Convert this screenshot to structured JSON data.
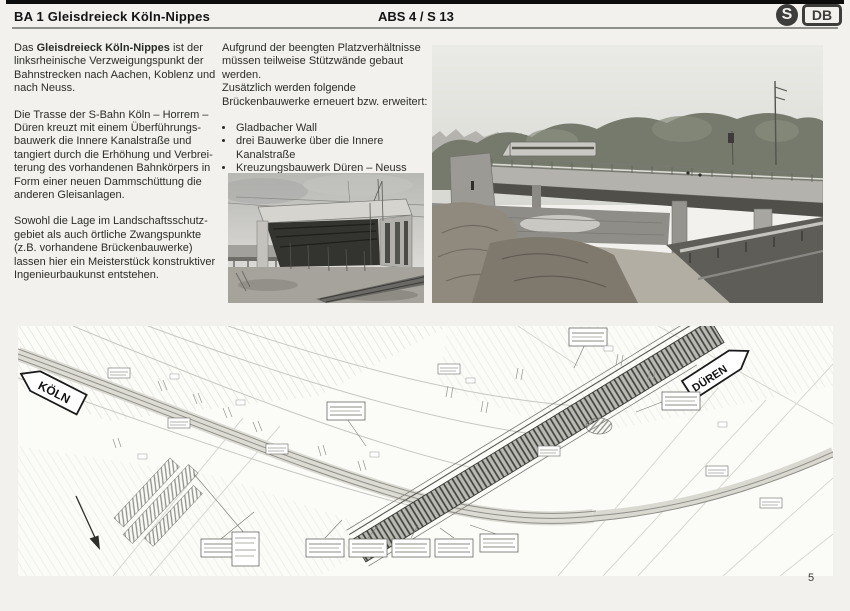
{
  "page": {
    "number": "5"
  },
  "header": {
    "title": "BA 1 Gleisdreieck Köln-Nippes",
    "section": "ABS 4 / S 13",
    "sbahn_letter": "S",
    "db_letters": "DB"
  },
  "columns": {
    "col1": {
      "para1_prefix": "Das ",
      "para1_bold": "Gleisdreieck Köln-Nippes",
      "para1_rest": " ist der linksrheinische Verzweigungspunkt der Bahnstrecken nach Aachen, Koblenz und nach Neuss.",
      "para2": "Die Trasse der S-Bahn Köln – Horrem – Düren kreuzt mit einem Überführungs­bauwerk die Innere Kanalstraße und tangiert durch die Erhöhung und Verbrei­terung des vorhandenen Bahnkörpers in Form einer neuen Dammschüttung die anderen Gleisanlagen.",
      "para3": "Sowohl die Lage im Landschaftsschutz­gebiet als auch örtliche Zwangspunkte (z.B. vorhandene Brückenbauwerke) lassen hier ein Meisterstück konstruktiver Ingenieurbaukunst entstehen."
    },
    "col2": {
      "para1": "Aufgrund der beengten Platzverhältnisse müssen teilweise Stützwände gebaut werden.",
      "para2": "Zusätzlich werden folgende Brückenbauwerke erneuert bzw. erweitert:",
      "bullets": [
        "Gladbacher Wall",
        "drei Bauwerke über die Innere Kanalstraße",
        "Kreuzungsbauwerk Düren – Neuss"
      ]
    }
  },
  "drawing": {
    "label_koeln": "KÖLN",
    "label_dueren": "DÜREN"
  }
}
